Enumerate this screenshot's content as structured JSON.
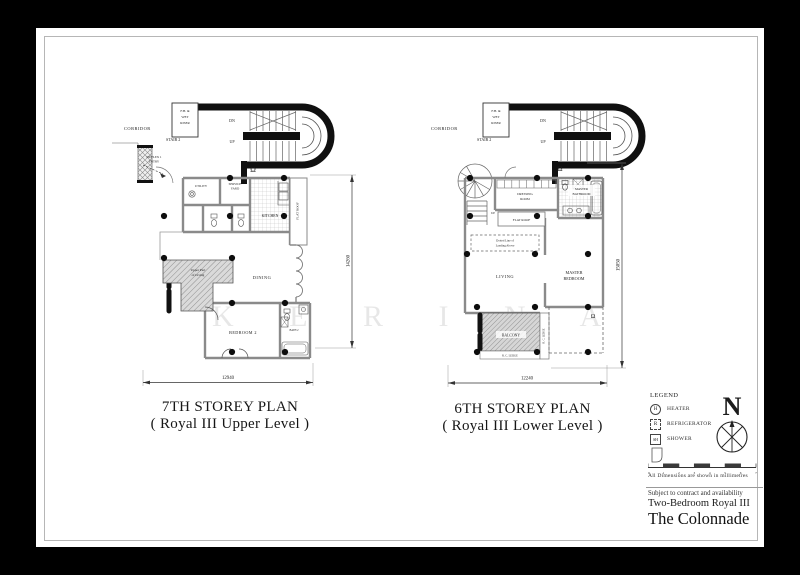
{
  "plans": {
    "left": {
      "title": "7TH STOREY PLAN",
      "subtitle": "( Royal III Upper Level )",
      "dim_width": "12940",
      "dim_height": "14260",
      "labels": {
        "corridor": "CORRIDOR",
        "stair": "STAIR 2",
        "riser_l1": "F.H. &",
        "riser_l2": "WET",
        "riser_l3": "RISER",
        "dn": "DN",
        "up": "UP",
        "duplex_l1": "DUPLEX 1",
        "duplex_l2": "ENTRY",
        "utility": "UTILITY",
        "service_l1": "SERVICE",
        "service_l2": "YARD",
        "kitchen": "KITCHEN",
        "flat_roof": "FLAT ROOF",
        "upper_l1": "Upper Part",
        "upper_l2": "of Living",
        "dining": "DINING",
        "bedroom2": "BEDROOM 2",
        "bath2": "BATH 2"
      }
    },
    "right": {
      "title": "6TH STOREY PLAN",
      "subtitle": "( Royal III Lower Level )",
      "dim_width": "12240",
      "dim_height": "15050",
      "labels": {
        "corridor": "CORRIDOR",
        "stair": "STAIR 2",
        "up2": "UP",
        "flat_roof": "FLAT ROOF",
        "dressing_l1": "DRESSING",
        "dressing_l2": "ROOM",
        "masterbath_l1": "MASTER",
        "masterbath_l2": "BATHROOM",
        "landing_l1": "Dotted Line of",
        "landing_l2": "Landing Above",
        "living": "LIVING",
        "master_l1": "MASTER",
        "master_l2": "BEDROOM",
        "balcony": "BALCONY",
        "rc_ledge_h": "R. C. LEDGE",
        "rc_ledge_v": "R. C. LEDGE"
      }
    }
  },
  "legend": {
    "title": "LEGEND",
    "items": [
      {
        "symbol": "H",
        "label": "HEATER"
      },
      {
        "symbol": "R",
        "label": "REFRIGERATOR"
      },
      {
        "symbol": "SH",
        "label": "SHOWER"
      }
    ],
    "north_label": "N",
    "scale_ticks": [
      "0",
      "1",
      "2",
      "3",
      "4",
      "5",
      "6",
      "7"
    ],
    "dimension_note": "All Dimensions are shown in millimetres"
  },
  "footer": {
    "disclaimer": "Subject to contract and availability",
    "unit_type": "Two-Bedroom Royal III",
    "project_name": "The Colonnade"
  },
  "watermark": "K E R I N A"
}
